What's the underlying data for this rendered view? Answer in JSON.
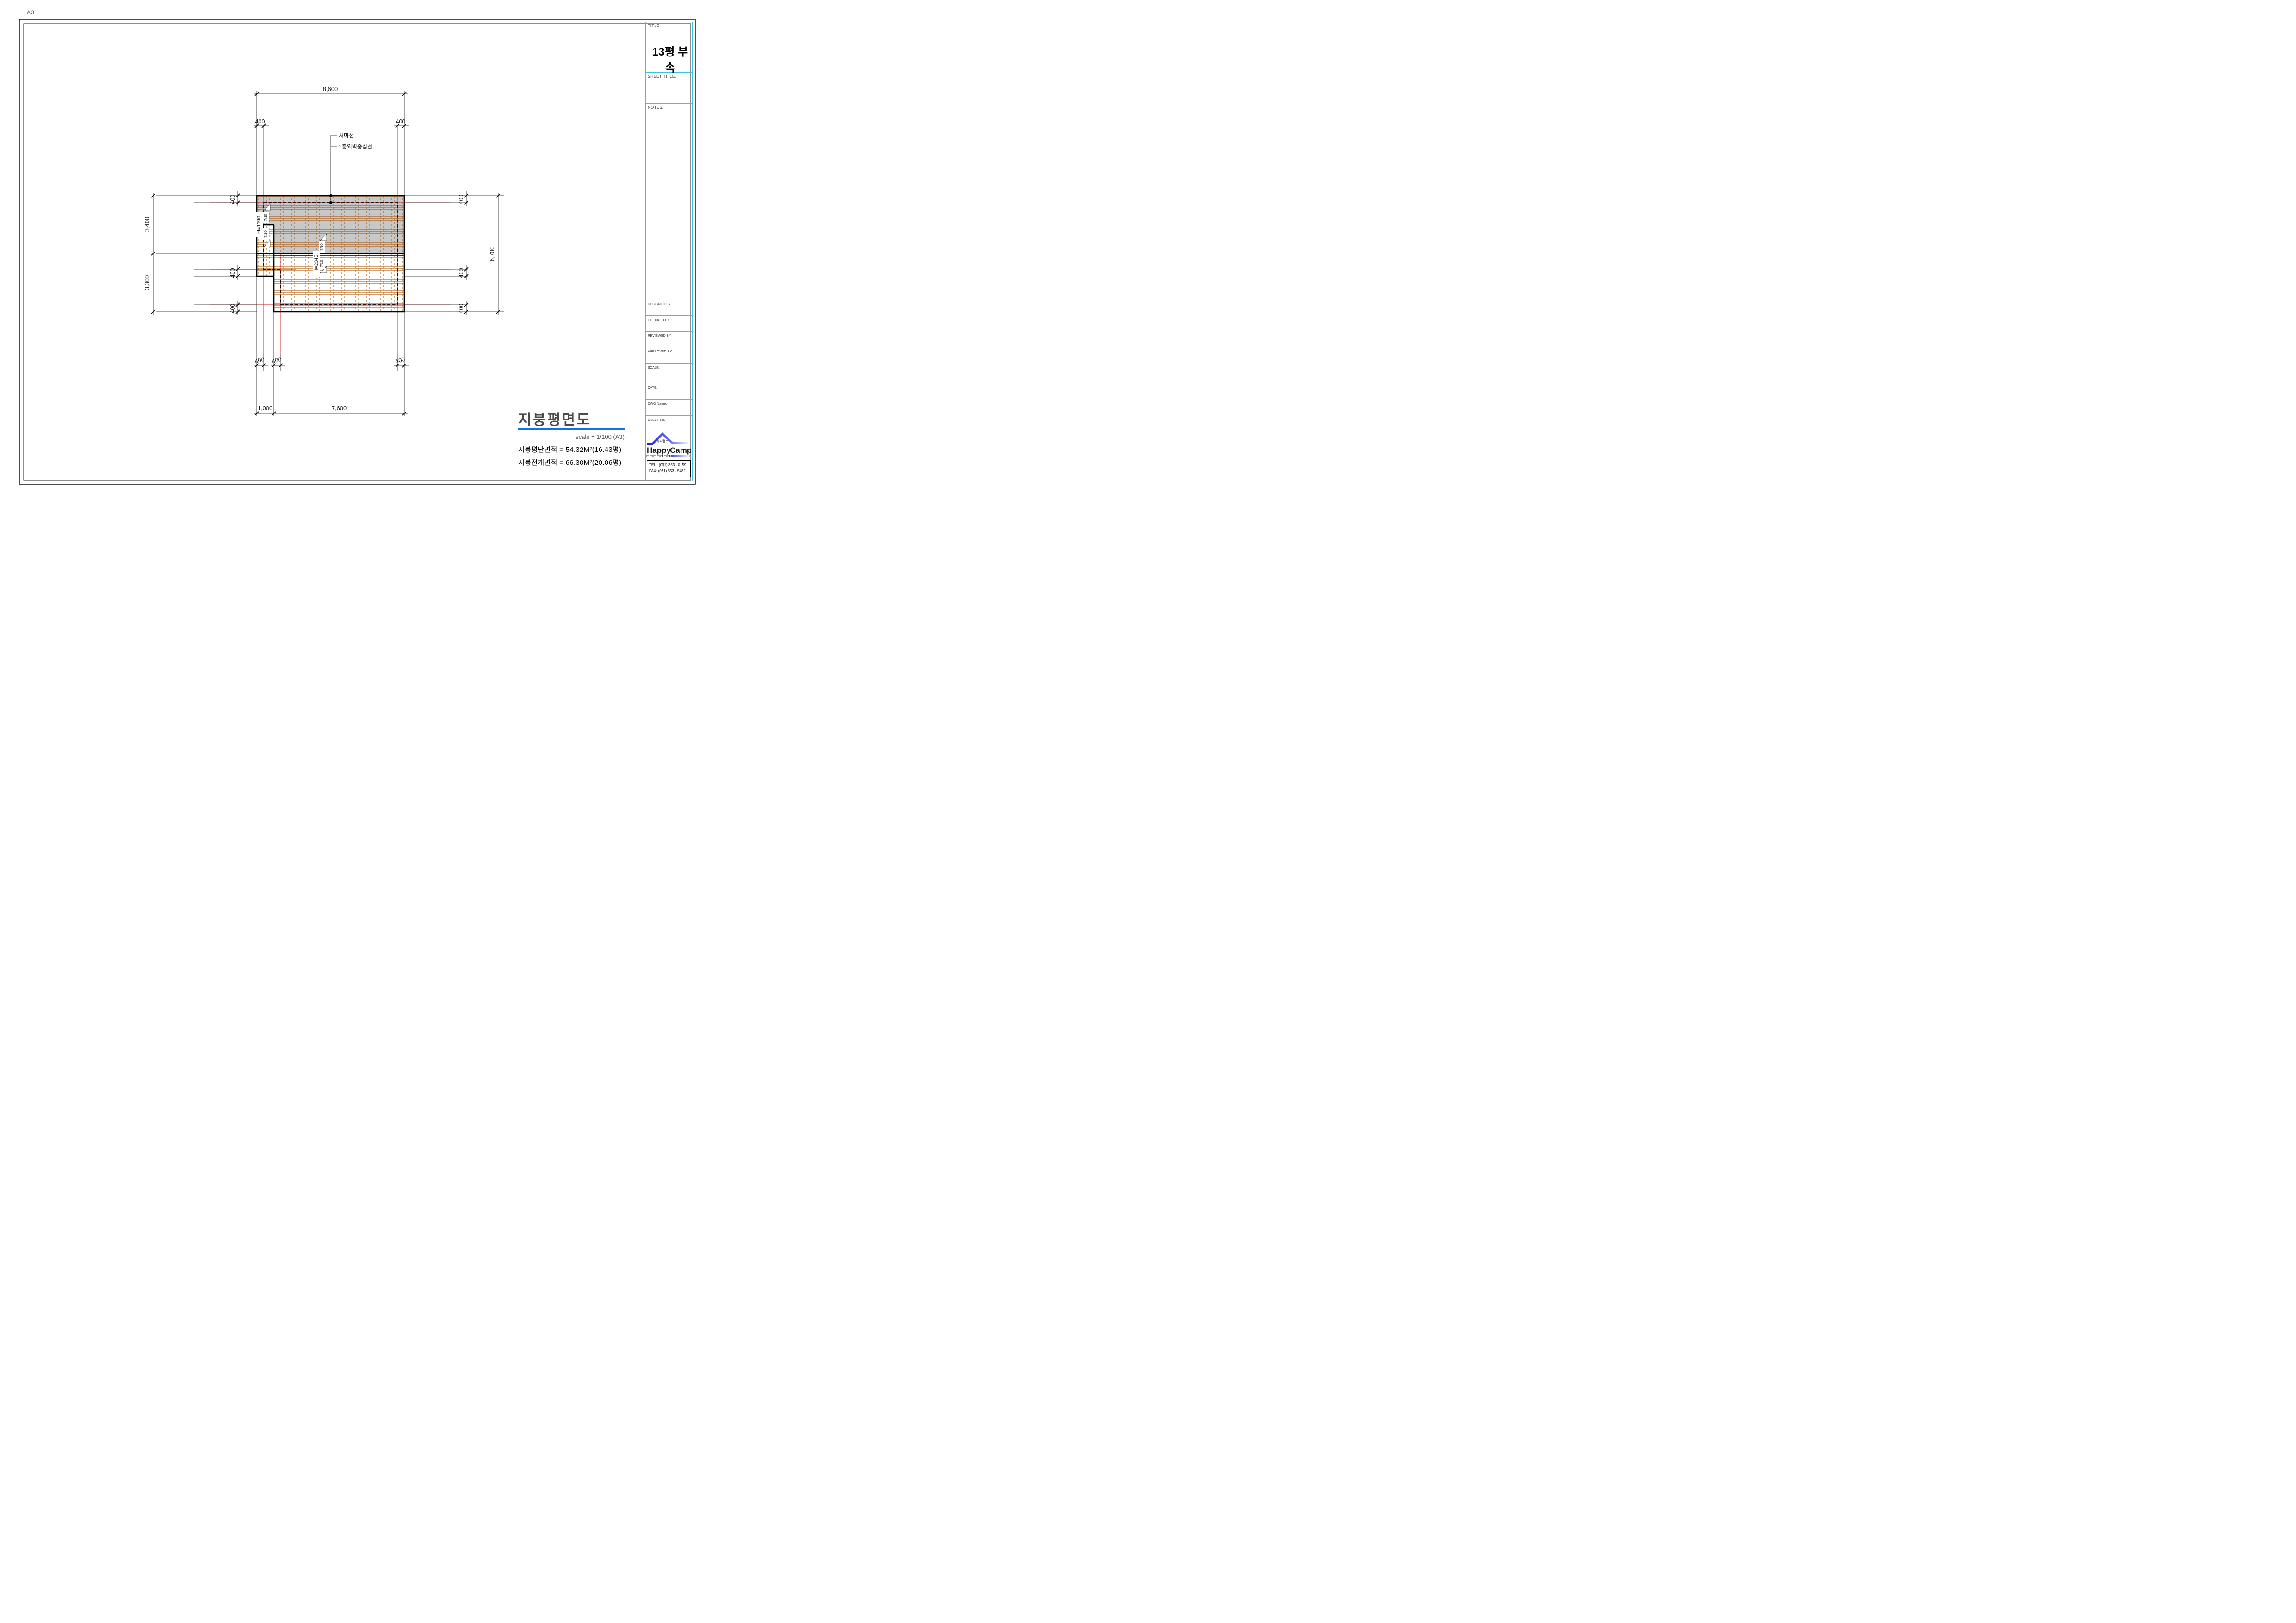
{
  "page": {
    "format_label": "A3"
  },
  "plan": {
    "dims": {
      "top": "8,600",
      "left_upper": "3,400",
      "left_lower": "3,300",
      "right": "6,700",
      "bottom_offset": "1,000",
      "bottom_main": "7,600",
      "eave": "400"
    },
    "labels": {
      "eave_line": "처마선",
      "wall_centerline": "1층외벽중심선",
      "height_upper_roof": "H=2345",
      "height_lower_roof": "H=1190",
      "slope": "7/10"
    }
  },
  "drawing_title": {
    "title": "지붕평면도",
    "scale": "scale = 1/100 (A3)",
    "roof_plan_area": "지붕평단면적 = 54.32M²(16.43평)",
    "roof_developed_area": "지붕전개면적 = 66.30M²(20.06평)"
  },
  "title_block": {
    "title_label": "TITLE.",
    "project_title": "13평 부속",
    "sheet_title_label": "SHEET TITLE.",
    "notes_label": "NOTES.",
    "designed_by": "DESIGNED BY",
    "checked_by": "CHECKED BY",
    "reviewed_by": "REVIEWED BY",
    "approved_by": "APPROVED BY",
    "scale_label": "SCALE.",
    "date_label": "DATE.",
    "dwg_name_label": "DWG Name.",
    "sheet_no_label": "SHEET No.",
    "logo": {
      "korean_name": "해피캠프",
      "name_red": "Happy",
      "name_green": "Camp",
      "tel": "TEL : (031) 353 - 0159",
      "fax": "FAX: (031) 353 - 5482"
    }
  },
  "colors": {
    "frame_accent": "#3fc0dc",
    "centerline_red": "#cc1414",
    "title_underline_blue": "#1470e8",
    "brick_line": "#c08040",
    "upper_roof_fill": "#c8c8c8",
    "logo_red": "#e01818",
    "logo_green": "#22aa22"
  }
}
